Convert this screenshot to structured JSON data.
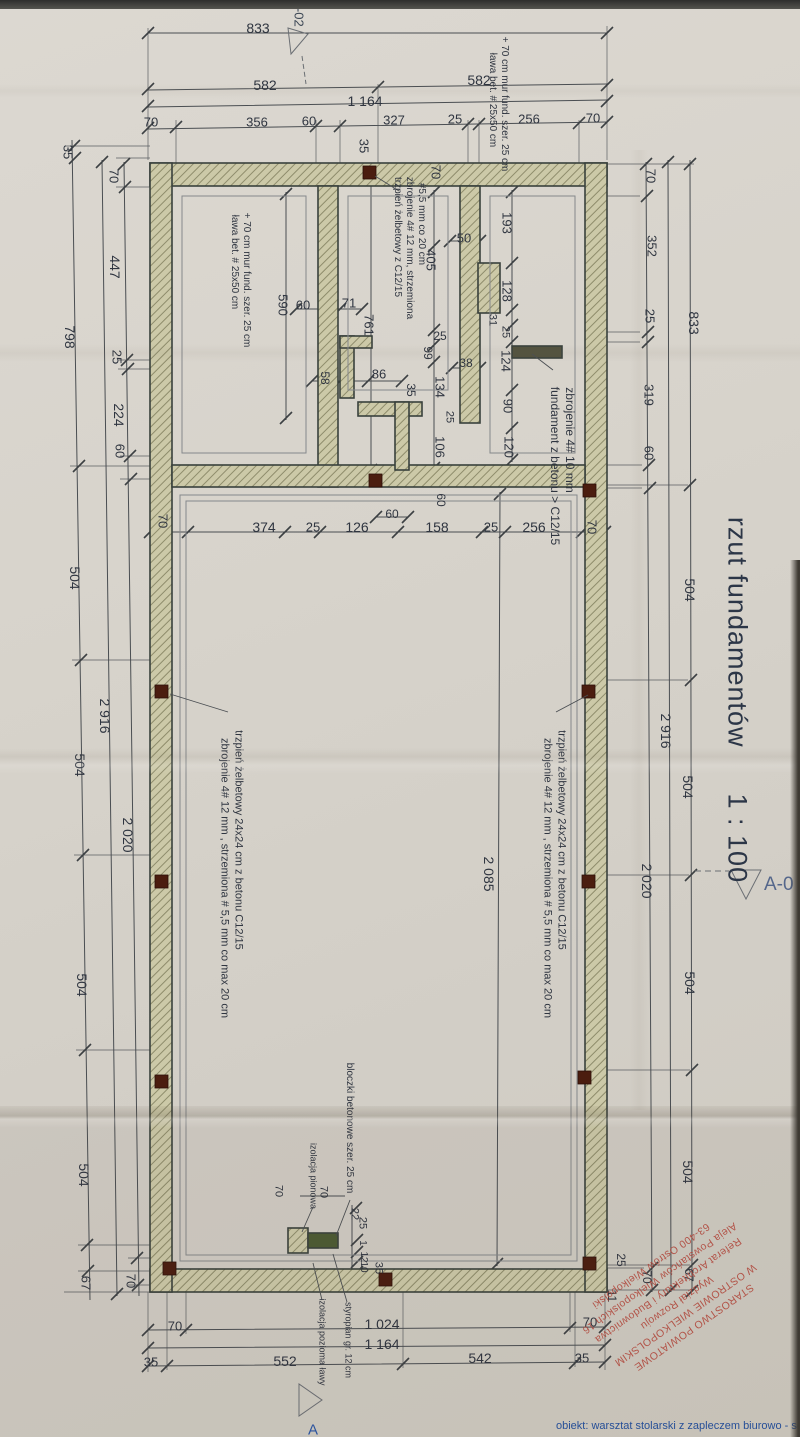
{
  "document": {
    "title": "rzut fundamentów",
    "scale_label": "1 : 100",
    "marker_right": "A-0",
    "marker_top_left": "A-02",
    "corner_letter": "A"
  },
  "footer": {
    "project_text": "obiekt: warsztat stolarski z zapleczem biurowo - socjalny"
  },
  "stamp": {
    "color": "#b5453a",
    "lines": [
      "STAROSTWO POWIATOWE",
      "W OSTROWIE WIELKOPOLSKIM",
      "Wydział Rozwoju",
      "Referat Architektury i Budownictwa",
      "Aleja Powstańców Wielkopolskich 16",
      "63-400 Ostrów Wielkopolski"
    ]
  },
  "colors": {
    "paper": "#d7d3cb",
    "line": "#4a4e52",
    "wall_fill": "#ccc9a8",
    "wall_hatch": "#8e8c6b",
    "column": "#4b1d0f",
    "stamp_red": "#b5453a",
    "accent_blue": "#2a56a5",
    "title_ink": "#2c3647"
  },
  "annotations": [
    {
      "t": "fundament z betonu > C12/15",
      "x": 555,
      "y": 466,
      "r": 90,
      "s": 12
    },
    {
      "t": "zbrojenie 4# 10 mm",
      "x": 570,
      "y": 440,
      "r": 90,
      "s": 12
    },
    {
      "t": "trzpień żelbetowy z C12/15",
      "x": 397,
      "y": 237,
      "r": 90,
      "s": 10
    },
    {
      "t": "zbrojenie 4# 12 mm, strzemiona",
      "x": 409,
      "y": 248,
      "r": 90,
      "s": 10
    },
    {
      "t": "#5,5 mm co 20 cm",
      "x": 421,
      "y": 224,
      "r": 90,
      "s": 10
    },
    {
      "t": "ława bet. # 25x50 cm",
      "x": 492,
      "y": 100,
      "r": 90,
      "s": 10
    },
    {
      "t": "+ 70 cm mur fund. szer. 25 cm",
      "x": 504,
      "y": 104,
      "r": 90,
      "s": 10
    },
    {
      "t": "ława bet. # 25x50 cm",
      "x": 234,
      "y": 262,
      "r": 90,
      "s": 10
    },
    {
      "t": "+ 70 cm mur fund. szer. 25 cm",
      "x": 246,
      "y": 280,
      "r": 90,
      "s": 10
    },
    {
      "t": "trzpień żelbetowy 24x24 cm z betonu C12/15",
      "x": 561,
      "y": 840,
      "r": 90,
      "s": 11
    },
    {
      "t": "zbrojenie 4# 12 mm , strzemiona # 5,5 mm co max 20 cm",
      "x": 547,
      "y": 878,
      "r": 90,
      "s": 11
    },
    {
      "t": "trzpień żelbetowy 24x24 cm z betonu C12/15",
      "x": 238,
      "y": 840,
      "r": 90,
      "s": 11
    },
    {
      "t": "zbrojenie 4# 12 mm , strzemiona # 5,5 mm co max 20 cm",
      "x": 224,
      "y": 878,
      "r": 90,
      "s": 11
    },
    {
      "t": "bloczki betonowe szer. 25 cm",
      "x": 349,
      "y": 1128,
      "r": 90,
      "s": 10
    },
    {
      "t": "izolacja pionowa",
      "x": 313,
      "y": 1176,
      "r": 90,
      "s": 9
    },
    {
      "t": "izolacja pozioma ławy",
      "x": 322,
      "y": 1342,
      "r": 90,
      "s": 9
    },
    {
      "t": "styropian gr. 12 cm",
      "x": 348,
      "y": 1340,
      "r": 90,
      "s": 9
    }
  ],
  "dimensions": [
    {
      "t": "833",
      "x": 258,
      "y": 28,
      "r": 0,
      "s": 14
    },
    {
      "t": "582",
      "x": 265,
      "y": 85,
      "r": 0,
      "s": 14
    },
    {
      "t": "582",
      "x": 479,
      "y": 80,
      "r": 0,
      "s": 14
    },
    {
      "t": "1 164",
      "x": 365,
      "y": 101,
      "r": 0,
      "s": 14
    },
    {
      "t": "70",
      "x": 151,
      "y": 122,
      "r": 0,
      "s": 13
    },
    {
      "t": "356",
      "x": 257,
      "y": 122,
      "r": 0,
      "s": 13
    },
    {
      "t": "60",
      "x": 309,
      "y": 121,
      "r": 0,
      "s": 13
    },
    {
      "t": "327",
      "x": 394,
      "y": 120,
      "r": 0,
      "s": 13
    },
    {
      "t": "25",
      "x": 455,
      "y": 119,
      "r": 0,
      "s": 13
    },
    {
      "t": "256",
      "x": 529,
      "y": 119,
      "r": 0,
      "s": 13
    },
    {
      "t": "70",
      "x": 593,
      "y": 118,
      "r": 0,
      "s": 13
    },
    {
      "t": "35",
      "x": 68,
      "y": 152,
      "r": 90,
      "s": 13
    },
    {
      "t": "70",
      "x": 114,
      "y": 176,
      "r": 90,
      "s": 13
    },
    {
      "t": "35",
      "x": 364,
      "y": 146,
      "r": 90,
      "s": 13
    },
    {
      "t": "70",
      "x": 436,
      "y": 172,
      "r": 90,
      "s": 13
    },
    {
      "t": "70",
      "x": 651,
      "y": 176,
      "r": 90,
      "s": 13
    },
    {
      "t": "352",
      "x": 652,
      "y": 246,
      "r": 90,
      "s": 13
    },
    {
      "t": "25",
      "x": 650,
      "y": 316,
      "r": 90,
      "s": 13
    },
    {
      "t": "319",
      "x": 649,
      "y": 395,
      "r": 90,
      "s": 13
    },
    {
      "t": "60",
      "x": 649,
      "y": 453,
      "r": 90,
      "s": 13
    },
    {
      "t": "833",
      "x": 694,
      "y": 323,
      "r": 90,
      "s": 14
    },
    {
      "t": "504",
      "x": 690,
      "y": 590,
      "r": 90,
      "s": 14
    },
    {
      "t": "2 916",
      "x": 666,
      "y": 731,
      "r": 90,
      "s": 14
    },
    {
      "t": "504",
      "x": 688,
      "y": 787,
      "r": 90,
      "s": 14
    },
    {
      "t": "2 020",
      "x": 647,
      "y": 881,
      "r": 90,
      "s": 14
    },
    {
      "t": "504",
      "x": 690,
      "y": 983,
      "r": 90,
      "s": 14
    },
    {
      "t": "504",
      "x": 688,
      "y": 1172,
      "r": 90,
      "s": 14
    },
    {
      "t": "25",
      "x": 621,
      "y": 1260,
      "r": 90,
      "s": 12
    },
    {
      "t": "70",
      "x": 647,
      "y": 1277,
      "r": 90,
      "s": 12
    },
    {
      "t": "67",
      "x": 689,
      "y": 1275,
      "r": 90,
      "s": 12
    },
    {
      "t": "11",
      "x": 612,
      "y": 1296,
      "r": 90,
      "s": 12
    },
    {
      "t": "70",
      "x": 175,
      "y": 1326,
      "r": 0,
      "s": 13
    },
    {
      "t": "1 024",
      "x": 382,
      "y": 1324,
      "r": 0,
      "s": 14
    },
    {
      "t": "1 164",
      "x": 382,
      "y": 1344,
      "r": 0,
      "s": 14
    },
    {
      "t": "35",
      "x": 151,
      "y": 1362,
      "r": 0,
      "s": 13
    },
    {
      "t": "552",
      "x": 285,
      "y": 1361,
      "r": 0,
      "s": 14
    },
    {
      "t": "542",
      "x": 480,
      "y": 1358,
      "r": 0,
      "s": 14
    },
    {
      "t": "35",
      "x": 582,
      "y": 1358,
      "r": 0,
      "s": 13
    },
    {
      "t": "70",
      "x": 590,
      "y": 1322,
      "r": 0,
      "s": 13
    },
    {
      "t": "798",
      "x": 70,
      "y": 337,
      "r": 90,
      "s": 14
    },
    {
      "t": "447",
      "x": 115,
      "y": 267,
      "r": 90,
      "s": 14
    },
    {
      "t": "25",
      "x": 117,
      "y": 357,
      "r": 90,
      "s": 13
    },
    {
      "t": "224",
      "x": 119,
      "y": 415,
      "r": 90,
      "s": 14
    },
    {
      "t": "60",
      "x": 120,
      "y": 451,
      "r": 90,
      "s": 13
    },
    {
      "t": "504",
      "x": 75,
      "y": 578,
      "r": 90,
      "s": 14
    },
    {
      "t": "2 916",
      "x": 105,
      "y": 716,
      "r": 90,
      "s": 14
    },
    {
      "t": "504",
      "x": 80,
      "y": 765,
      "r": 90,
      "s": 14
    },
    {
      "t": "2 020",
      "x": 128,
      "y": 835,
      "r": 90,
      "s": 14
    },
    {
      "t": "70",
      "x": 163,
      "y": 521,
      "r": 90,
      "s": 13
    },
    {
      "t": "504",
      "x": 82,
      "y": 985,
      "r": 90,
      "s": 14
    },
    {
      "t": "504",
      "x": 84,
      "y": 1175,
      "r": 90,
      "s": 14
    },
    {
      "t": "67",
      "x": 86,
      "y": 1283,
      "r": 90,
      "s": 13
    },
    {
      "t": "70",
      "x": 131,
      "y": 1281,
      "r": 90,
      "s": 13
    },
    {
      "t": "193",
      "x": 507,
      "y": 223,
      "r": 90,
      "s": 13
    },
    {
      "t": "50",
      "x": 464,
      "y": 238,
      "r": 0,
      "s": 13
    },
    {
      "t": "128",
      "x": 507,
      "y": 291,
      "r": 90,
      "s": 13
    },
    {
      "t": "31",
      "x": 492,
      "y": 320,
      "r": 90,
      "s": 11
    },
    {
      "t": "25",
      "x": 505,
      "y": 332,
      "r": 90,
      "s": 11
    },
    {
      "t": "124",
      "x": 506,
      "y": 361,
      "r": 90,
      "s": 13
    },
    {
      "t": "38",
      "x": 466,
      "y": 363,
      "r": 0,
      "s": 12
    },
    {
      "t": "90",
      "x": 508,
      "y": 406,
      "r": 90,
      "s": 13
    },
    {
      "t": "120",
      "x": 509,
      "y": 447,
      "r": 90,
      "s": 13
    },
    {
      "t": "405",
      "x": 431,
      "y": 260,
      "r": 90,
      "s": 13
    },
    {
      "t": "25",
      "x": 440,
      "y": 336,
      "r": 0,
      "s": 12
    },
    {
      "t": "99",
      "x": 428,
      "y": 353,
      "r": 90,
      "s": 12
    },
    {
      "t": "590",
      "x": 283,
      "y": 305,
      "r": 90,
      "s": 13
    },
    {
      "t": "60",
      "x": 303,
      "y": 305,
      "r": 0,
      "s": 13
    },
    {
      "t": "71",
      "x": 349,
      "y": 303,
      "r": 0,
      "s": 13
    },
    {
      "t": "761",
      "x": 369,
      "y": 325,
      "r": 90,
      "s": 13
    },
    {
      "t": "58",
      "x": 325,
      "y": 378,
      "r": 90,
      "s": 12
    },
    {
      "t": "86",
      "x": 379,
      "y": 374,
      "r": 0,
      "s": 13
    },
    {
      "t": "35",
      "x": 411,
      "y": 390,
      "r": 90,
      "s": 12
    },
    {
      "t": "134",
      "x": 440,
      "y": 387,
      "r": 90,
      "s": 13
    },
    {
      "t": "106",
      "x": 440,
      "y": 447,
      "r": 90,
      "s": 13
    },
    {
      "t": "25",
      "x": 449,
      "y": 417,
      "r": 90,
      "s": 11
    },
    {
      "t": "60",
      "x": 441,
      "y": 500,
      "r": 90,
      "s": 12
    },
    {
      "t": "60",
      "x": 392,
      "y": 514,
      "r": 0,
      "s": 12
    },
    {
      "t": "374",
      "x": 264,
      "y": 527,
      "r": 0,
      "s": 14
    },
    {
      "t": "25",
      "x": 313,
      "y": 527,
      "r": 0,
      "s": 13
    },
    {
      "t": "126",
      "x": 357,
      "y": 527,
      "r": 0,
      "s": 14
    },
    {
      "t": "158",
      "x": 437,
      "y": 527,
      "r": 0,
      "s": 14
    },
    {
      "t": "25",
      "x": 491,
      "y": 527,
      "r": 0,
      "s": 13
    },
    {
      "t": "256",
      "x": 534,
      "y": 527,
      "r": 0,
      "s": 14
    },
    {
      "t": "70",
      "x": 592,
      "y": 527,
      "r": 90,
      "s": 13
    },
    {
      "t": "2 085",
      "x": 489,
      "y": 874,
      "r": 90,
      "s": 14
    },
    {
      "t": "70",
      "x": 323,
      "y": 1192,
      "r": 90,
      "s": 11
    },
    {
      "t": "70",
      "x": 278,
      "y": 1191,
      "r": 90,
      "s": 11
    },
    {
      "t": "22",
      "x": 354,
      "y": 1214,
      "r": 90,
      "s": 11
    },
    {
      "t": "25",
      "x": 362,
      "y": 1223,
      "r": 90,
      "s": 11
    },
    {
      "t": "1",
      "x": 362,
      "y": 1243,
      "r": 90,
      "s": 10
    },
    {
      "t": "12",
      "x": 363,
      "y": 1257,
      "r": 90,
      "s": 10
    },
    {
      "t": "10",
      "x": 363,
      "y": 1267,
      "r": 90,
      "s": 10
    },
    {
      "t": "35",
      "x": 378,
      "y": 1268,
      "r": 90,
      "s": 11
    }
  ]
}
